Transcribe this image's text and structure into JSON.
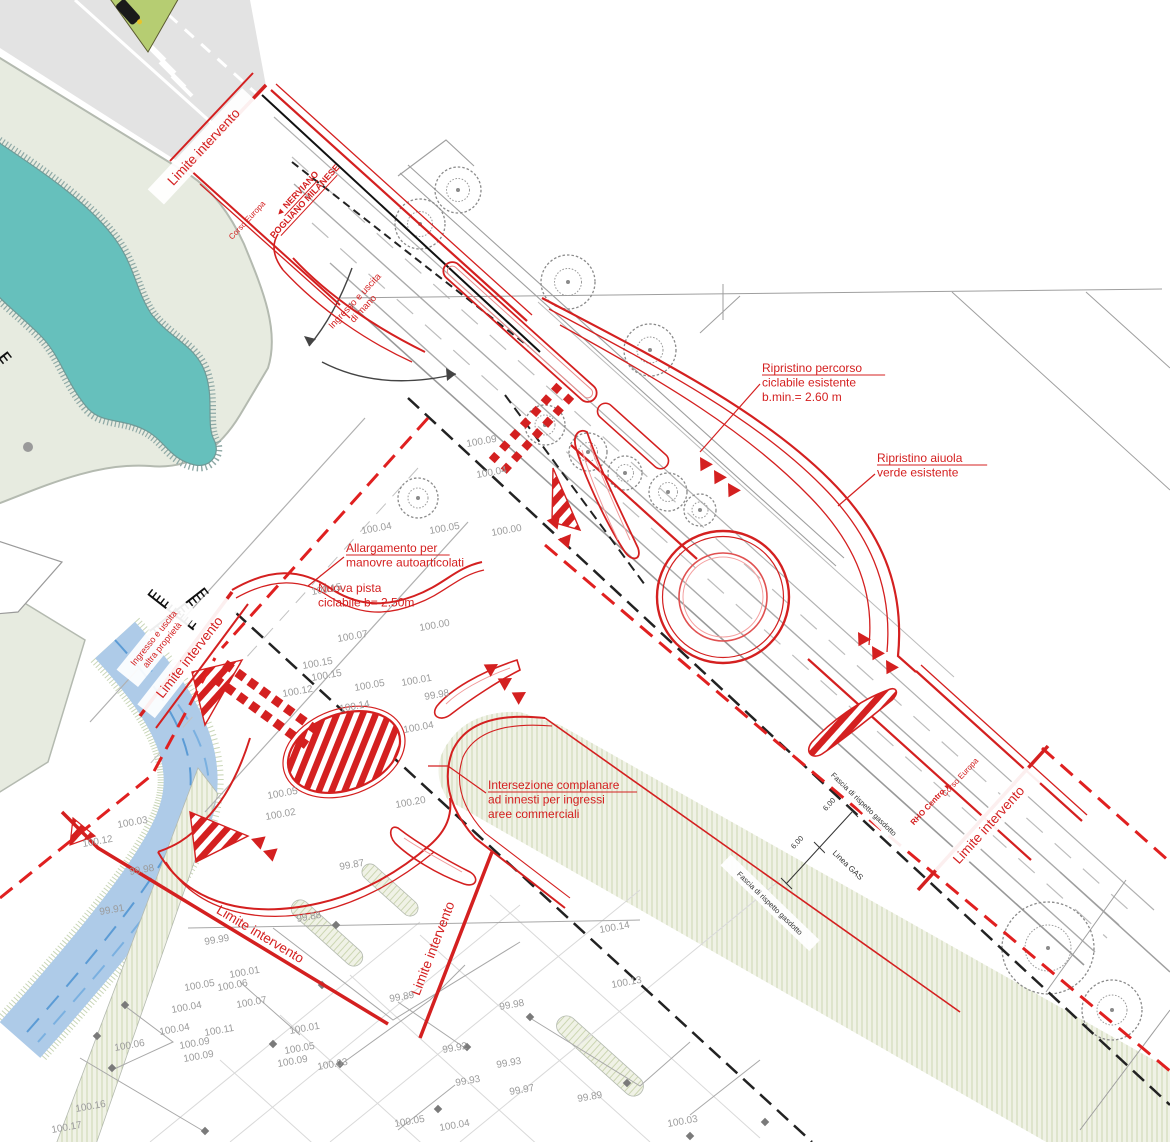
{
  "colors": {
    "accent_red": "#d42020",
    "existing_gray": "#9a9a9a",
    "vegetation_sage": "#e7ebe0",
    "hatch_band": "#f0f2e6",
    "water_teal": "#66c0bc",
    "canal_blue": "#aecbe8"
  },
  "labels": [
    {
      "id": "limite-intervento-1",
      "lines": [
        "Limite intervento"
      ],
      "x": 207,
      "y": 150,
      "r": -47,
      "size": 13.5,
      "bold": 0,
      "underline": 0,
      "color": "red",
      "anchor": "m",
      "bg": 1
    },
    {
      "id": "direction-nerviano",
      "lines": [
        "◄ NERVIANO",
        "POGLIANO MILANESE"
      ],
      "x": 299,
      "y": 196,
      "r": -47,
      "size": 9,
      "bold": 1,
      "underline": 2,
      "color": "red",
      "anchor": "m",
      "bg": 0
    },
    {
      "id": "corso-europa-label-top",
      "lines": [
        "Corso Europa"
      ],
      "x": 249,
      "y": 222,
      "r": -47,
      "size": 8,
      "bold": 0,
      "underline": 0,
      "color": "red",
      "anchor": "m",
      "bg": 0
    },
    {
      "id": "ingresso-uscita-di-mano",
      "lines": [
        "Ingresso e uscita",
        "di mano"
      ],
      "x": 357,
      "y": 303,
      "r": -47,
      "size": 9.5,
      "bold": 0,
      "underline": 0,
      "color": "red",
      "anchor": "m",
      "bg": 0
    },
    {
      "id": "ripristino-percorso",
      "lines": [
        "Ripristino percorso",
        "ciclabile esistente",
        "b.min.= 2.60 m"
      ],
      "x": 762,
      "y": 372,
      "r": 0,
      "size": 12,
      "bold": 0,
      "underline": 1,
      "color": "red",
      "anchor": "s",
      "bg": 0
    },
    {
      "id": "ripristino-aiuola",
      "lines": [
        "Ripristino aiuola",
        "verde esistente"
      ],
      "x": 877,
      "y": 462,
      "r": 0,
      "size": 12,
      "bold": 0,
      "underline": 1,
      "color": "red",
      "anchor": "s",
      "bg": 0
    },
    {
      "id": "allargamento-manovre",
      "lines": [
        "Allargamento per",
        "manovre autoarticolati"
      ],
      "x": 346,
      "y": 552,
      "r": 0,
      "size": 12,
      "bold": 0,
      "underline": 1,
      "color": "red",
      "anchor": "s",
      "bg": 0
    },
    {
      "id": "nuova-pista",
      "lines": [
        "Nuova pista",
        "ciclabile b= 2.50m"
      ],
      "x": 318,
      "y": 592,
      "r": 0,
      "size": 12,
      "bold": 0,
      "underline": 0,
      "color": "red",
      "anchor": "s",
      "bg": 0
    },
    {
      "id": "ingresso-uscita-altra",
      "lines": [
        "Ingresso e uscita",
        "altra proprietà"
      ],
      "x": 156,
      "y": 640,
      "r": -51,
      "size": 9,
      "bold": 0,
      "underline": 0,
      "color": "red",
      "anchor": "m",
      "bg": 1
    },
    {
      "id": "limite-intervento-2",
      "lines": [
        "Limite intervento"
      ],
      "x": 193,
      "y": 660,
      "r": -52,
      "size": 13.5,
      "bold": 0,
      "underline": 0,
      "color": "red",
      "anchor": "m",
      "bg": 1
    },
    {
      "id": "intersezione-complanare",
      "lines": [
        "Intersezione complanare",
        "ad innesti per ingressi",
        "aree commerciali"
      ],
      "x": 488,
      "y": 789,
      "r": 0,
      "size": 12,
      "bold": 0,
      "underline": 1,
      "color": "red",
      "anchor": "s",
      "bg": 0
    },
    {
      "id": "fascia-gasdotto-1",
      "lines": [
        "Fascia di rispetto gasdotto"
      ],
      "x": 862,
      "y": 806,
      "r": 44,
      "size": 7.5,
      "bold": 0,
      "underline": 0,
      "color": "dark",
      "anchor": "m",
      "bg": 1
    },
    {
      "id": "fascia-gasdotto-2",
      "lines": [
        "Fascia di rispetto gasdotto"
      ],
      "x": 768,
      "y": 905,
      "r": 44,
      "size": 7.5,
      "bold": 0,
      "underline": 0,
      "color": "dark",
      "anchor": "m",
      "bg": 1
    },
    {
      "id": "linea-gas",
      "lines": [
        "Linea GAS"
      ],
      "x": 846,
      "y": 867,
      "r": 44,
      "size": 8,
      "bold": 0,
      "underline": 0,
      "color": "dark",
      "anchor": "m",
      "bg": 1
    },
    {
      "id": "dim-600-a",
      "lines": [
        "6.00"
      ],
      "x": 831,
      "y": 806,
      "r": -48,
      "size": 7.5,
      "bold": 0,
      "underline": 0,
      "color": "dark",
      "anchor": "m",
      "bg": 0
    },
    {
      "id": "dim-600-b",
      "lines": [
        "6.00"
      ],
      "x": 799,
      "y": 844,
      "r": -48,
      "size": 7.5,
      "bold": 0,
      "underline": 0,
      "color": "dark",
      "anchor": "m",
      "bg": 0
    },
    {
      "id": "corso-europa-label-right",
      "lines": [
        "Corso Europa"
      ],
      "x": 962,
      "y": 779,
      "r": -47,
      "size": 8,
      "bold": 0,
      "underline": 0,
      "color": "red",
      "anchor": "m",
      "bg": 0
    },
    {
      "id": "rho-centro",
      "lines": [
        "RHO Centro ►"
      ],
      "x": 933,
      "y": 805,
      "r": -47,
      "size": 8,
      "bold": 1,
      "underline": 0,
      "color": "red",
      "anchor": "m",
      "bg": 0
    },
    {
      "id": "limite-intervento-3",
      "lines": [
        "Limite intervento"
      ],
      "x": 992,
      "y": 828,
      "r": -48,
      "size": 13.5,
      "bold": 0,
      "underline": 0,
      "color": "red",
      "anchor": "m",
      "bg": 1
    },
    {
      "id": "limite-intervento-4",
      "lines": [
        "Limite intervento"
      ],
      "x": 258,
      "y": 938,
      "r": 31,
      "size": 13.5,
      "bold": 0,
      "underline": 0,
      "color": "red",
      "anchor": "m",
      "bg": 0
    },
    {
      "id": "limite-intervento-5",
      "lines": [
        "Limite intervento"
      ],
      "x": 437,
      "y": 950,
      "r": -69,
      "size": 13.5,
      "bold": 0,
      "underline": 0,
      "color": "red",
      "anchor": "m",
      "bg": 0
    }
  ],
  "elevations": [
    {
      "v": "100.09",
      "x": 467,
      "y": 447
    },
    {
      "v": "100.04",
      "x": 477,
      "y": 478
    },
    {
      "v": "100.04",
      "x": 362,
      "y": 534
    },
    {
      "v": "100.05",
      "x": 430,
      "y": 534
    },
    {
      "v": "100.00",
      "x": 492,
      "y": 536
    },
    {
      "v": "100.15",
      "x": 312,
      "y": 595
    },
    {
      "v": "100.00",
      "x": 420,
      "y": 631
    },
    {
      "v": "100.07",
      "x": 338,
      "y": 642
    },
    {
      "v": "100.15",
      "x": 303,
      "y": 669
    },
    {
      "v": "100.15",
      "x": 312,
      "y": 681
    },
    {
      "v": "100.12",
      "x": 283,
      "y": 697
    },
    {
      "v": "100.05",
      "x": 355,
      "y": 691
    },
    {
      "v": "100.01",
      "x": 402,
      "y": 686
    },
    {
      "v": "99.98",
      "x": 425,
      "y": 700
    },
    {
      "v": "100.14",
      "x": 340,
      "y": 712
    },
    {
      "v": "100.04",
      "x": 404,
      "y": 733
    },
    {
      "v": "100.05",
      "x": 268,
      "y": 799
    },
    {
      "v": "100.02",
      "x": 266,
      "y": 820
    },
    {
      "v": "100.20",
      "x": 396,
      "y": 808
    },
    {
      "v": "100.03",
      "x": 118,
      "y": 828
    },
    {
      "v": "100.12",
      "x": 83,
      "y": 847
    },
    {
      "v": "99.98",
      "x": 130,
      "y": 875
    },
    {
      "v": "99.91",
      "x": 100,
      "y": 915
    },
    {
      "v": "99.87",
      "x": 340,
      "y": 870
    },
    {
      "v": "99.88",
      "x": 297,
      "y": 922
    },
    {
      "v": "99.99",
      "x": 205,
      "y": 945
    },
    {
      "v": "100.01",
      "x": 230,
      "y": 978
    },
    {
      "v": "100.05",
      "x": 185,
      "y": 991
    },
    {
      "v": "100.06",
      "x": 218,
      "y": 991
    },
    {
      "v": "100.07",
      "x": 237,
      "y": 1008
    },
    {
      "v": "100.04",
      "x": 172,
      "y": 1013
    },
    {
      "v": "100.04",
      "x": 160,
      "y": 1035
    },
    {
      "v": "100.11",
      "x": 205,
      "y": 1036
    },
    {
      "v": "100.01",
      "x": 290,
      "y": 1034
    },
    {
      "v": "100.06",
      "x": 115,
      "y": 1051
    },
    {
      "v": "100.09",
      "x": 180,
      "y": 1049
    },
    {
      "v": "100.09",
      "x": 184,
      "y": 1062
    },
    {
      "v": "100.05",
      "x": 285,
      "y": 1054
    },
    {
      "v": "100.09",
      "x": 278,
      "y": 1067
    },
    {
      "v": "100.03",
      "x": 318,
      "y": 1070
    },
    {
      "v": "100.16",
      "x": 76,
      "y": 1112
    },
    {
      "v": "100.17",
      "x": 52,
      "y": 1133
    },
    {
      "v": "99.89",
      "x": 390,
      "y": 1002
    },
    {
      "v": "99.98",
      "x": 500,
      "y": 1010
    },
    {
      "v": "99.92",
      "x": 443,
      "y": 1053
    },
    {
      "v": "99.93",
      "x": 497,
      "y": 1068
    },
    {
      "v": "99.93",
      "x": 456,
      "y": 1086
    },
    {
      "v": "99.97",
      "x": 510,
      "y": 1095
    },
    {
      "v": "99.89",
      "x": 578,
      "y": 1102
    },
    {
      "v": "100.03",
      "x": 668,
      "y": 1127
    },
    {
      "v": "100.05",
      "x": 395,
      "y": 1127
    },
    {
      "v": "100.04",
      "x": 440,
      "y": 1131
    },
    {
      "v": "100.14",
      "x": 600,
      "y": 933
    },
    {
      "v": "100.13",
      "x": 612,
      "y": 988
    }
  ]
}
